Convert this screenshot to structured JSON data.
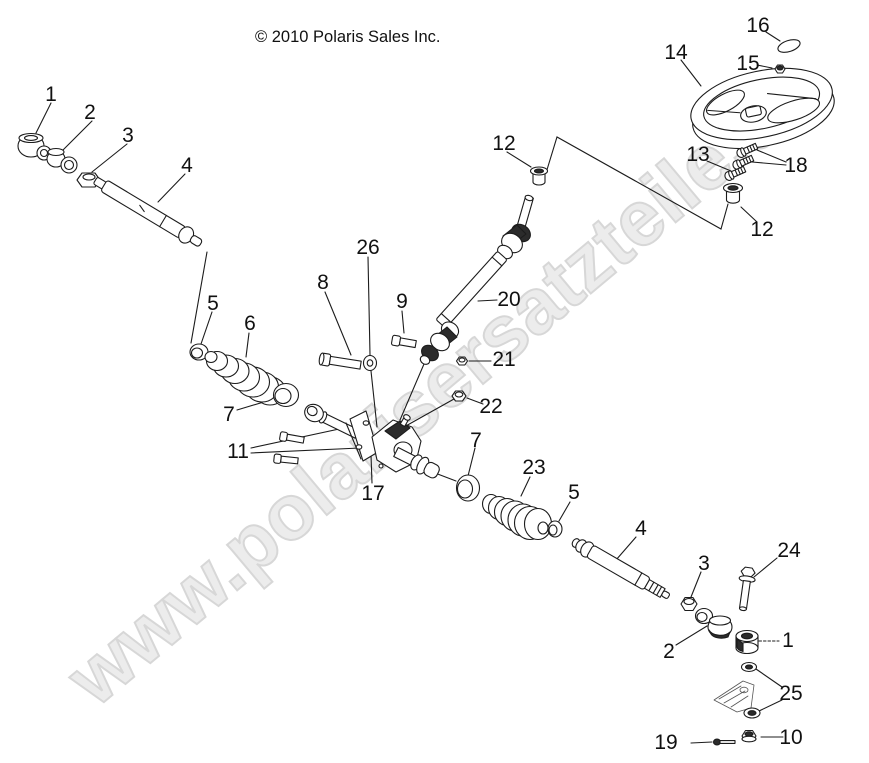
{
  "copyright": "© 2010 Polaris Sales Inc.",
  "watermark": {
    "text": "www.polarisersatzteile.de"
  },
  "colors": {
    "line": "#1c1c1c",
    "background": "#ffffff",
    "watermark_fill": "#ececec",
    "watermark_outline": "#d7d7d7"
  },
  "diagram": {
    "callouts": [
      {
        "label": "1"
      },
      {
        "label": "2"
      },
      {
        "label": "3"
      },
      {
        "label": "4"
      },
      {
        "label": "5"
      },
      {
        "label": "6"
      },
      {
        "label": "7"
      },
      {
        "label": "8"
      },
      {
        "label": "9"
      },
      {
        "label": "11"
      },
      {
        "label": "12"
      },
      {
        "label": "12"
      },
      {
        "label": "13"
      },
      {
        "label": "14"
      },
      {
        "label": "15"
      },
      {
        "label": "16"
      },
      {
        "label": "17"
      },
      {
        "label": "18"
      },
      {
        "label": "19"
      },
      {
        "label": "20"
      },
      {
        "label": "21"
      },
      {
        "label": "22"
      },
      {
        "label": "23"
      },
      {
        "label": "24"
      },
      {
        "label": "25"
      },
      {
        "label": "26"
      },
      {
        "label": "7"
      },
      {
        "label": "5"
      },
      {
        "label": "4"
      },
      {
        "label": "3"
      },
      {
        "label": "2"
      },
      {
        "label": "1"
      },
      {
        "label": "10"
      }
    ]
  }
}
